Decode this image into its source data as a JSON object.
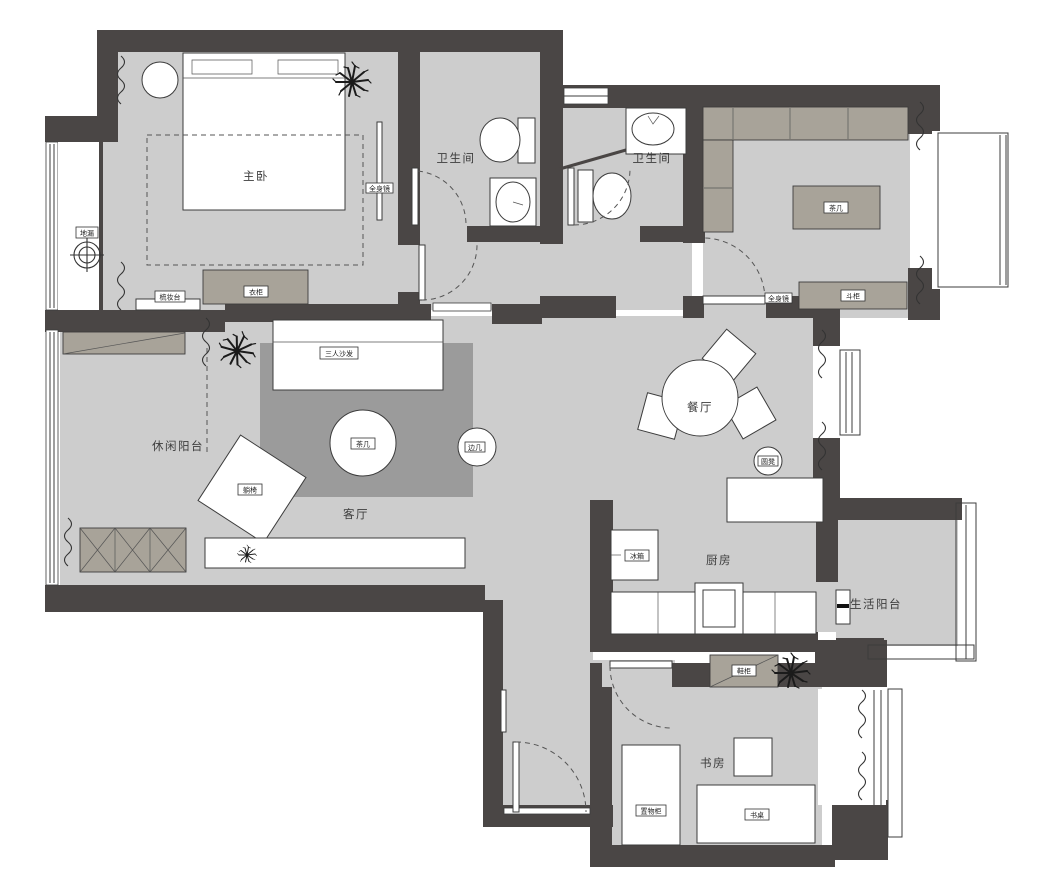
{
  "rooms": {
    "master_bedroom": "主卧",
    "bathroom_main": "卫生间",
    "bathroom_guest": "卫生间",
    "leisure_balcony": "休闲阳台",
    "living_room": "客厅",
    "dining_room": "餐厅",
    "kitchen": "厨房",
    "service_balcony": "生活阳台",
    "study": "书房"
  },
  "furniture": {
    "wardrobe": "衣柜",
    "dressing_table": "梳妆台",
    "master_mirror": "全身镜",
    "floor_drain": "地漏",
    "sofa": "三人沙发",
    "coffee_table": "茶几",
    "side_table": "边几",
    "lounge_chair": "躺椅",
    "tea_table": "茶几",
    "tea_cabinet": "斗柜",
    "tea_mirror": "全身镜",
    "dining_stool": "圆凳",
    "fridge": "冰箱",
    "shoe_cabinet": "鞋柜",
    "storage_cabinet": "置物柜",
    "desk": "书桌"
  },
  "colors": {
    "wall": "#4a4645",
    "floor": "#cdcdcd",
    "rug": "#9b9b9b",
    "cabinet": "#a8a399",
    "line": "#3c3c3c"
  }
}
